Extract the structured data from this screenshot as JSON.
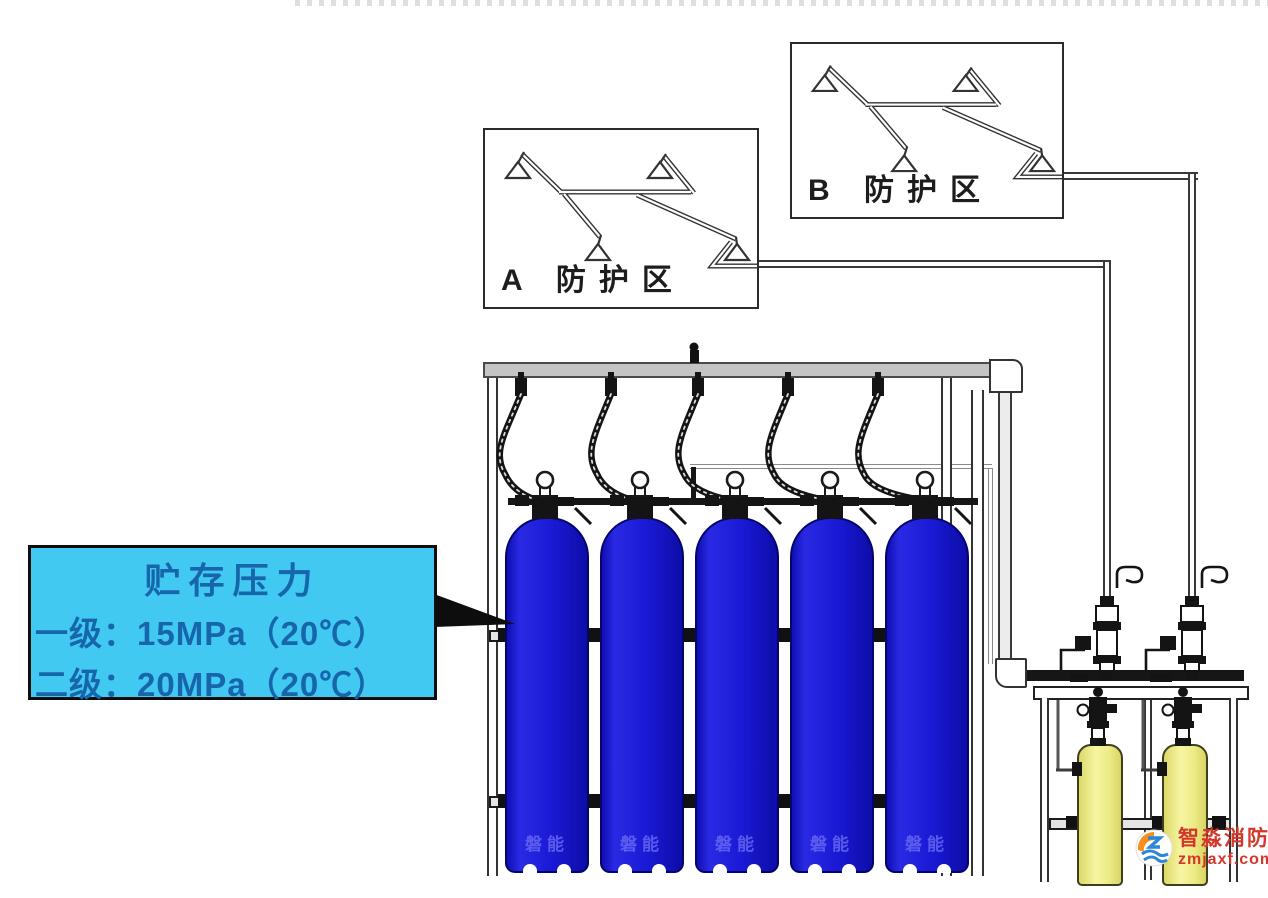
{
  "zones": {
    "a": {
      "label": "A 防护区"
    },
    "b": {
      "label": "B 防护区"
    }
  },
  "callout": {
    "title": "贮存压力",
    "line1": "一级：15MPa（20℃）",
    "line2": "二级：20MPa（20℃）",
    "bg_color": "#41c9f2",
    "text_color": "#1766ab"
  },
  "cylinders": {
    "count": 5,
    "brand_watermark": "磐能",
    "body_color": "#1a1ad6"
  },
  "pilot_cylinders": {
    "count": 2,
    "body_color": "#efec85"
  },
  "site_watermark": {
    "brand": "智淼消防",
    "domain": "zmjaxf.com",
    "text_color": "#d4372a"
  }
}
